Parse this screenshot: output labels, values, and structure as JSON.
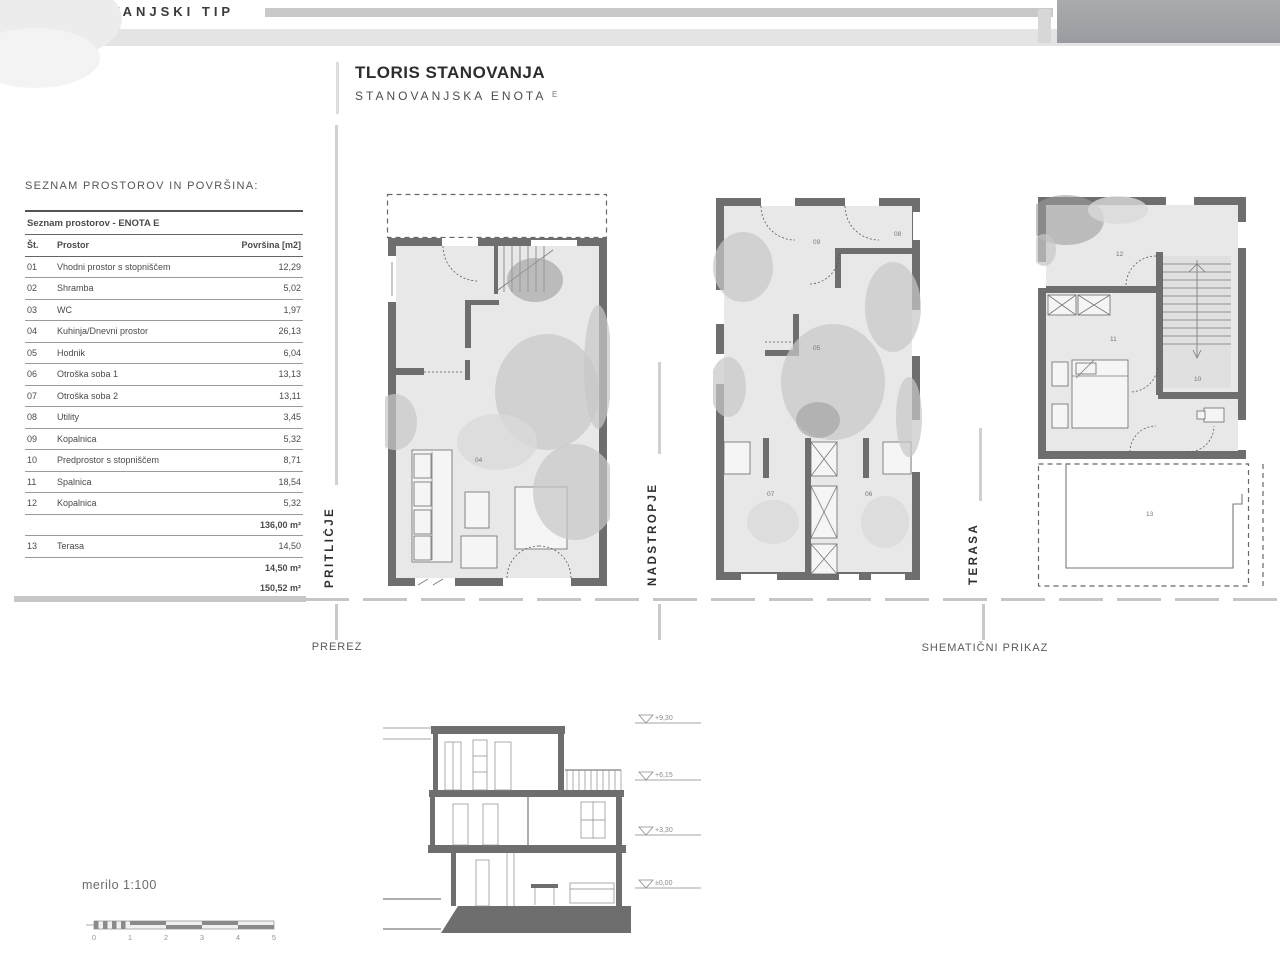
{
  "header": {
    "strip_title": "ANOVANJSKI TIP",
    "title": "TLORIS STANOVANJA",
    "subtitle": "STANOVANJSKA ENOTA",
    "subtitle_suffix": "E"
  },
  "room_table": {
    "section_label": "SEZNAM PROSTOROV IN POVRŠINA:",
    "table_title": "Seznam prostorov - ENOTA E",
    "col_no": "Št.",
    "col_room": "Prostor",
    "col_area": "Površina [m2]",
    "rows": [
      {
        "no": "01",
        "room": "Vhodni prostor s stopniščem",
        "area": "12,29"
      },
      {
        "no": "02",
        "room": "Shramba",
        "area": "5,02"
      },
      {
        "no": "03",
        "room": "WC",
        "area": "1,97"
      },
      {
        "no": "04",
        "room": "Kuhinja/Dnevni prostor",
        "area": "26,13"
      },
      {
        "no": "05",
        "room": "Hodnik",
        "area": "6,04"
      },
      {
        "no": "06",
        "room": "Otroška soba 1",
        "area": "13,13"
      },
      {
        "no": "07",
        "room": "Otroška soba 2",
        "area": "13,11"
      },
      {
        "no": "08",
        "room": "Utility",
        "area": "3,45"
      },
      {
        "no": "09",
        "room": "Kopalnica",
        "area": "5,32"
      },
      {
        "no": "10",
        "room": "Predprostor s stopniščem",
        "area": "8,71"
      },
      {
        "no": "11",
        "room": "Spalnica",
        "area": "18,54"
      },
      {
        "no": "12",
        "room": "Kopalnica",
        "area": "5,32"
      }
    ],
    "subtotal_interior": "136,00 m²",
    "terrace_row": {
      "no": "13",
      "room": "Terasa",
      "area": "14,50"
    },
    "subtotal_terrace": "14,50 m²",
    "total": "150,52 m²"
  },
  "plans": {
    "pritlicje_label": "PRITLIČJE",
    "nadstropje_label": "NADSTROPJE",
    "terasa_label": "TERASA",
    "prerez_label": "PREREZ",
    "shematicni_label": "SHEMATIČNI PRIKAZ",
    "room_numbers": {
      "p1_04": "04",
      "p2_09": "09",
      "p2_08": "08",
      "p2_05": "05",
      "p2_07": "07",
      "p2_06": "06",
      "p3_12": "12",
      "p3_11": "11",
      "p3_10": "10",
      "p3_13": "13"
    }
  },
  "section": {
    "levels": [
      "+9,30",
      "+6,15",
      "+3,30",
      "±0,00"
    ]
  },
  "scale": {
    "label": "merilo 1:100",
    "ticks": [
      "0",
      "1",
      "2",
      "3",
      "4",
      "5"
    ]
  }
}
